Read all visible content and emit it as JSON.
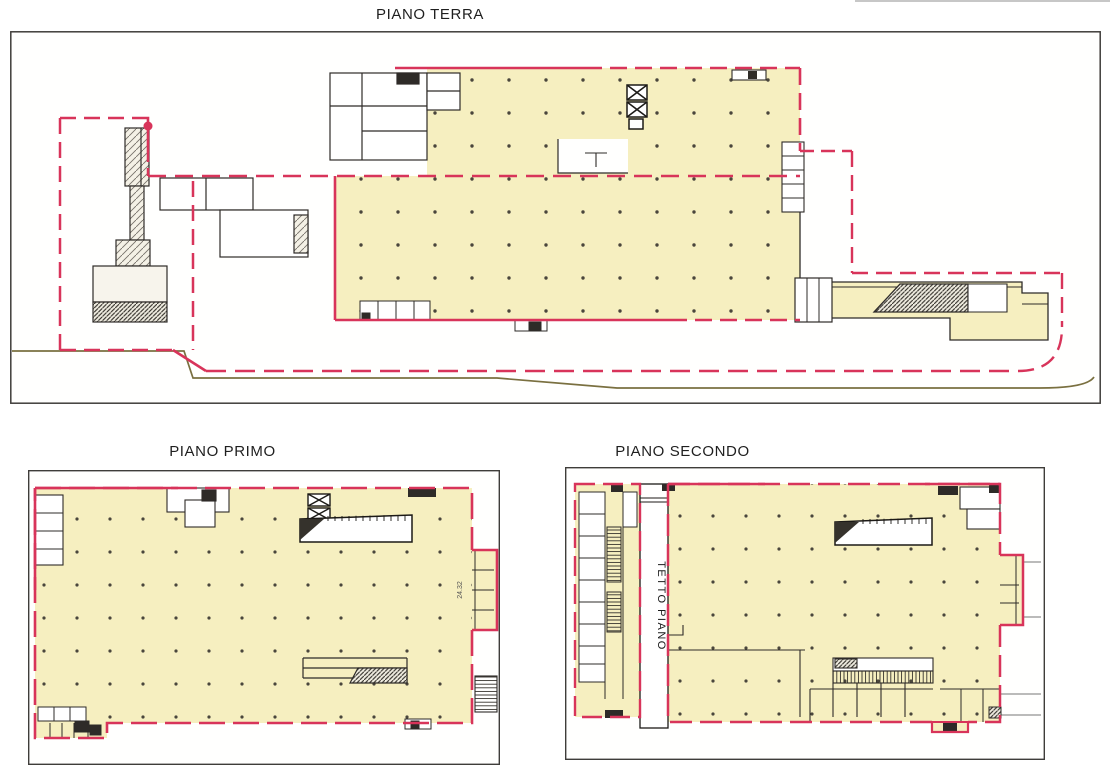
{
  "document": {
    "type": "architectural-floor-plans",
    "background": "#ffffff"
  },
  "plans": [
    {
      "id": "piano-terra",
      "title": "PIANO TERRA"
    },
    {
      "id": "piano-primo",
      "title": "PIANO PRIMO"
    },
    {
      "id": "piano-secondo",
      "title": "PIANO SECONDO"
    }
  ],
  "labels": {
    "roof_area": "TETTO PIANO",
    "dimension": "24.32"
  },
  "colors": {
    "floor_fill": "#f6efc0",
    "boundary_red": "#d8345a",
    "wall_dark": "#2e2b28",
    "frame_gray": "#3f3d3a",
    "site_line_olive": "#7a7040",
    "column_dot": "#4a463c"
  },
  "icons": [
    {
      "name": "elevator-icon",
      "shape": "crossed-box"
    },
    {
      "name": "stair-icon",
      "shape": "hatched-treads"
    },
    {
      "name": "ramp-icon",
      "shape": "hatched-wedge"
    }
  ]
}
